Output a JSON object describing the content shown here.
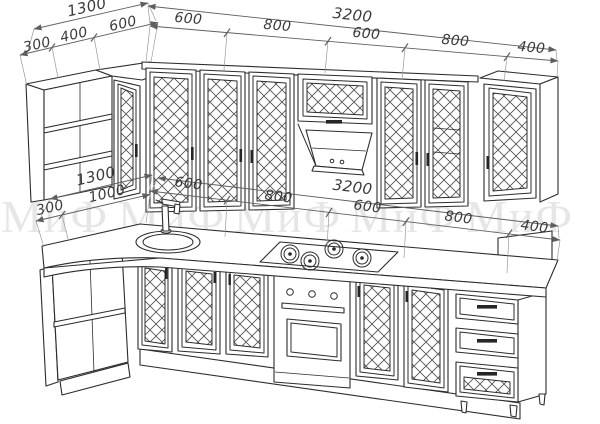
{
  "drawing": {
    "kind": "kitchen-set-technical-elevation"
  },
  "watermark": {
    "text": "МиФ",
    "color": "#e6e6e6"
  },
  "colors": {
    "line": "#2c2c2c",
    "dimension": "#5f5f5f",
    "watermark": "#e6e6e6",
    "background": "#ffffff"
  },
  "dims": {
    "top_left": {
      "overall": "1300",
      "segments": [
        "300",
        "400",
        "600"
      ]
    },
    "top_run": {
      "overall": "3200",
      "segments": [
        "600",
        "800",
        "600",
        "800",
        "400"
      ]
    },
    "bottom_left": {
      "overall": "1300",
      "segments": [
        "300",
        "1000"
      ]
    },
    "bottom_run": {
      "overall": "3200",
      "segments": [
        "600",
        "800",
        "600",
        "800",
        "400"
      ]
    }
  }
}
